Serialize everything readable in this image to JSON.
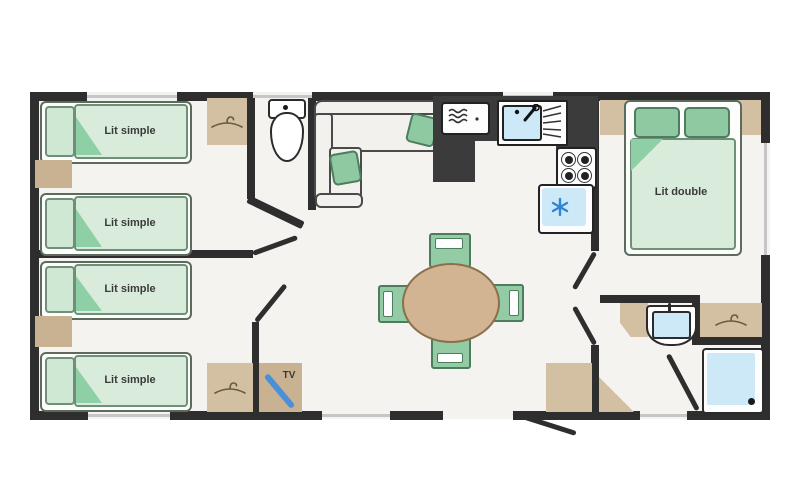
{
  "floorplan": {
    "type": "mobile-home-floor-plan",
    "beds": [
      {
        "label": "Lit simple"
      },
      {
        "label": "Lit simple"
      },
      {
        "label": "Lit simple"
      },
      {
        "label": "Lit simple"
      }
    ],
    "double_bed": {
      "label": "Lit double"
    },
    "tv_cabinet": {
      "label": "TV"
    },
    "icons": {
      "wardrobes": "hanger-icon",
      "fridge": "snowflake-icon",
      "microwave": "microwave-waves-icon",
      "sink": "faucet-and-drainer-icon",
      "stove": "four-burners-icon",
      "shower": "drain-icon",
      "toilet": "toilet-icon"
    },
    "colors": {
      "wall": "#2e2e2e",
      "floor": "#f4f3ef",
      "wood": "#d3bfa2",
      "wood_dark": "#c9b291",
      "bed_fill": "#d9ecdc",
      "bed_border": "#6f8f78",
      "green_accent": "#8fc9a1",
      "water_blue": "#cde9f7",
      "snowflake_blue": "#2f86d6",
      "tv_blue": "#4a90d9",
      "counter_dark": "#3b3b3b"
    }
  }
}
